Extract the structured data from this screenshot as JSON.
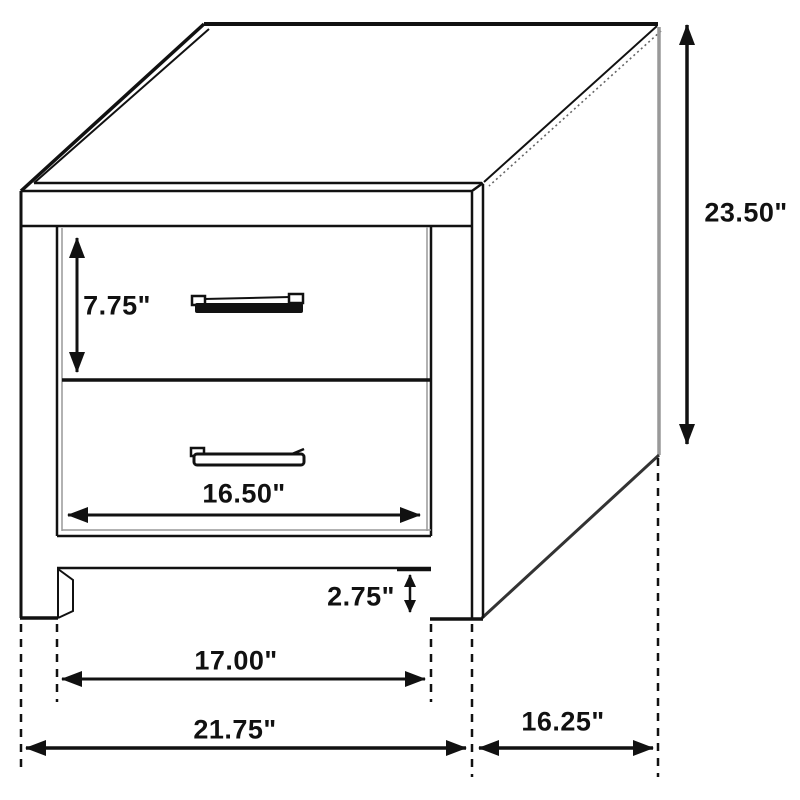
{
  "page": {
    "background": "#ffffff"
  },
  "diagram": {
    "name": "two-drawer-nightstand-dimension-diagram",
    "object": "nightstand with two drawers, isometric line drawing",
    "units": "inches",
    "line_color": "#111111",
    "shade_color": "#999999",
    "dimensions": {
      "drawer_front_height": {
        "label": "7.75\"",
        "value": 7.75,
        "measures": "top drawer front height"
      },
      "overall_height": {
        "label": "23.50\"",
        "value": 23.5,
        "measures": "overall height"
      },
      "drawer_width": {
        "label": "16.50\"",
        "value": 16.5,
        "measures": "drawer front width"
      },
      "base_clearance": {
        "label": "2.75\"",
        "value": 2.75,
        "measures": "bottom rail to floor"
      },
      "inner_width": {
        "label": "17.00\"",
        "value": 17.0,
        "measures": "width between legs"
      },
      "overall_width": {
        "label": "21.75\"",
        "value": 21.75,
        "measures": "overall width"
      },
      "depth": {
        "label": "16.25\"",
        "value": 16.25,
        "measures": "side depth"
      }
    }
  }
}
